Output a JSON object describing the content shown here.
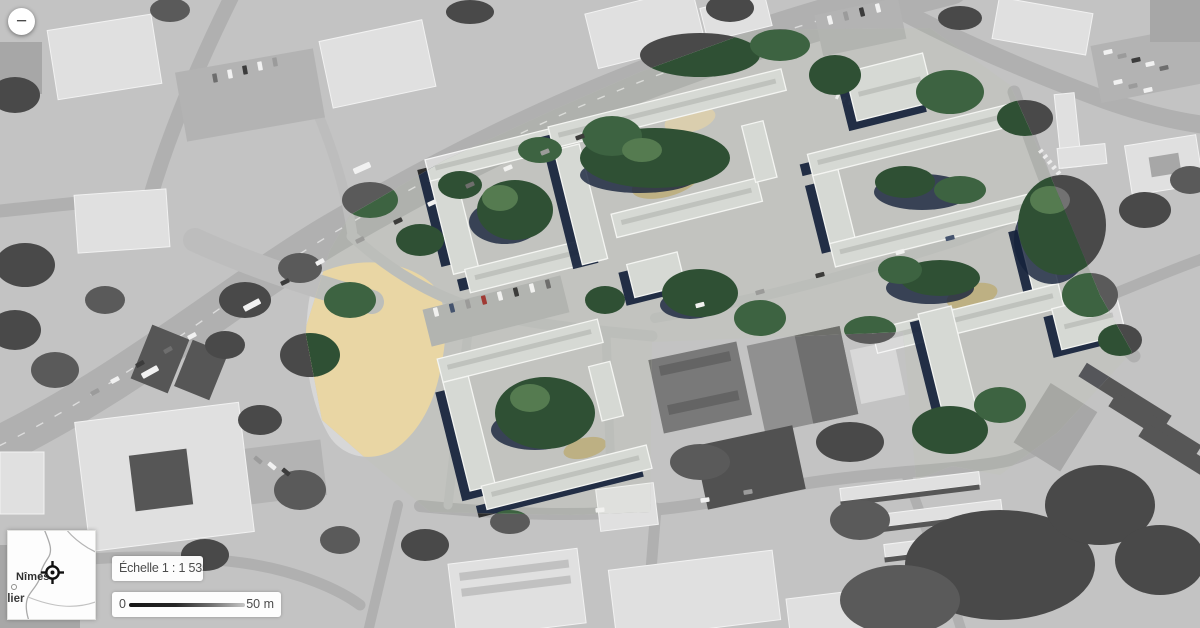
{
  "controls": {
    "zoom_out": "−"
  },
  "minimap": {
    "city": "Nîmes",
    "partial_city": "llier"
  },
  "scalebox": {
    "label": "Échelle 1 : 1 535"
  },
  "scalebar": {
    "start": "0",
    "end": "50 m"
  },
  "palette": {
    "roof": "#d6d9d4",
    "roof_edge": "#f4f5f2",
    "shadow": "#15223b",
    "tree": "#2f5034",
    "tree_light": "#3d6341",
    "tree_highlight": "#557b50",
    "sand": "#e9d6a4",
    "grass": "#bdb083",
    "road": "#afb1ad",
    "ground": "#c2c3bf"
  }
}
